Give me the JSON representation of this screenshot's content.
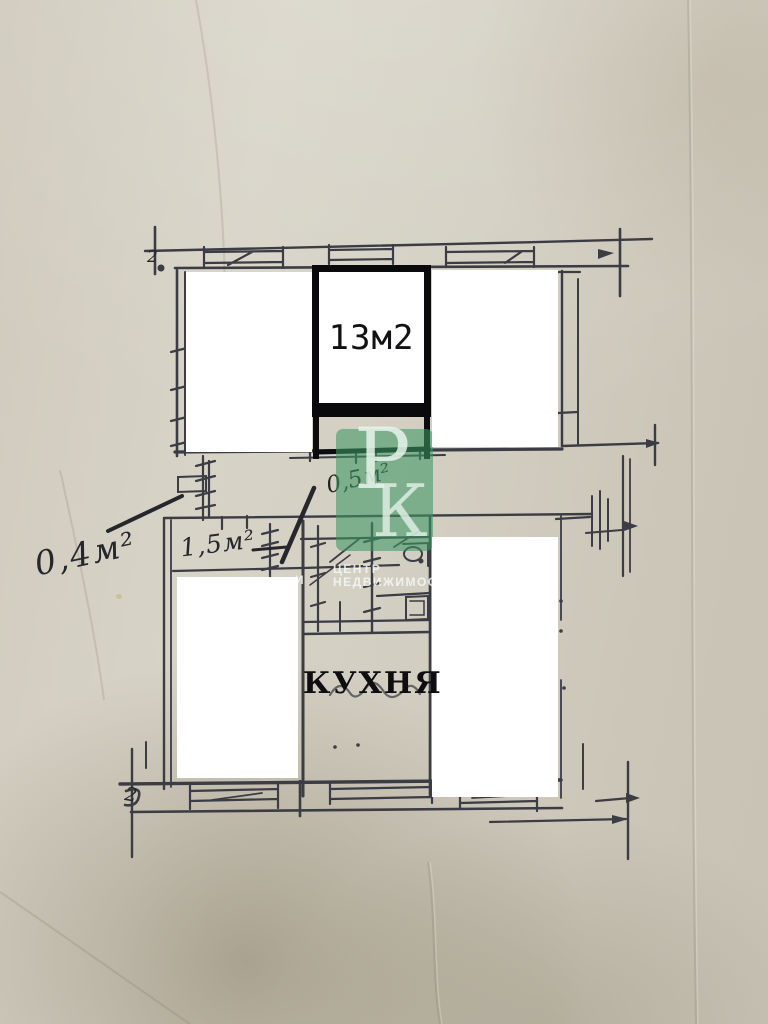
{
  "photo": {
    "labels": {
      "room_area": "13м2",
      "kitchen": "КУХНЯ"
    },
    "handwritten": {
      "left_area": "0,4м²",
      "corridor_area": "1,5м²",
      "small_area": "0,5м²",
      "top_left_mark": "2",
      "bottom_left_mark": "2"
    },
    "watermark": {
      "letter_p": "Р",
      "letter_k": "К",
      "caption_line1": "ЦЕНТР",
      "caption_line2": "НЕДВИЖИМОСТИ",
      "stray_letter": "И",
      "color": "#4f9f74"
    },
    "colors": {
      "paper": "#d2cec1",
      "pencil": "#3b3c44",
      "ink": "#26262c",
      "marker": "#0a0a0c",
      "redaction": "#ffffff"
    }
  }
}
